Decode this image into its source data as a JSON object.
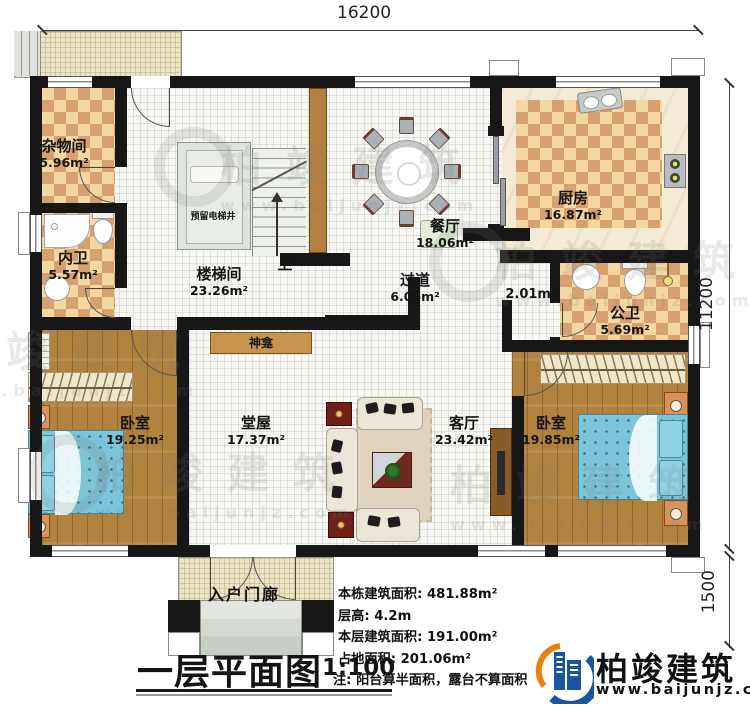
{
  "dims": {
    "top": "16200",
    "right": "11200",
    "porch": "1500"
  },
  "title": {
    "text": "一层平面图",
    "scale": "1:100"
  },
  "rooms": {
    "storage": {
      "name": "杂物间",
      "area": "5.96m²"
    },
    "inner_bath": {
      "name": "内卫",
      "area": "5.57m²"
    },
    "stairwell": {
      "name": "楼梯间",
      "area": "23.26m²"
    },
    "elevator": {
      "name": "预留电梯井"
    },
    "up": {
      "name": "上"
    },
    "dining": {
      "name": "餐厅",
      "area": "18.06m²"
    },
    "kitchen": {
      "name": "厨房",
      "area": "16.87m²"
    },
    "hallway": {
      "name": "过道",
      "area": "6.05m²"
    },
    "closet": {
      "area": "2.01m²"
    },
    "public_bath": {
      "name": "公卫",
      "area": "5.69m²"
    },
    "bedroom_left": {
      "name": "卧室",
      "area": "19.25m²"
    },
    "main_hall": {
      "name": "堂屋",
      "area": "17.37m²"
    },
    "living": {
      "name": "客厅",
      "area": "23.42m²"
    },
    "bedroom_right": {
      "name": "卧室",
      "area": "19.85m²"
    },
    "shrine": {
      "name": "神龛"
    },
    "porch": {
      "name": "入户门廊"
    }
  },
  "info": {
    "building_area": {
      "label": "本栋建筑面积:",
      "value": "481.88m²"
    },
    "floor_height": {
      "label": "层高:",
      "value": "4.2m"
    },
    "floor_area": {
      "label": "本层建筑面积:",
      "value": "191.00m²"
    },
    "footprint": {
      "label": "占地面积:",
      "value": "201.06m²"
    },
    "note": {
      "label": "注:",
      "value": "阳台算半面积，露台不算面积"
    }
  },
  "brand": {
    "name": "柏竣建筑",
    "site": "www.baijunjz.com"
  },
  "watermark": {
    "name": "柏竣建筑",
    "site": "www.baijunjz.com"
  },
  "colors": {
    "wall": "#171717",
    "tile_dark": "#d5a171",
    "tile_light": "#f4d7a0",
    "wood": "#b1813e",
    "bed": "#7cc4d8",
    "brand_blue": "#1a56a0",
    "brand_orange": "#e8820c"
  }
}
